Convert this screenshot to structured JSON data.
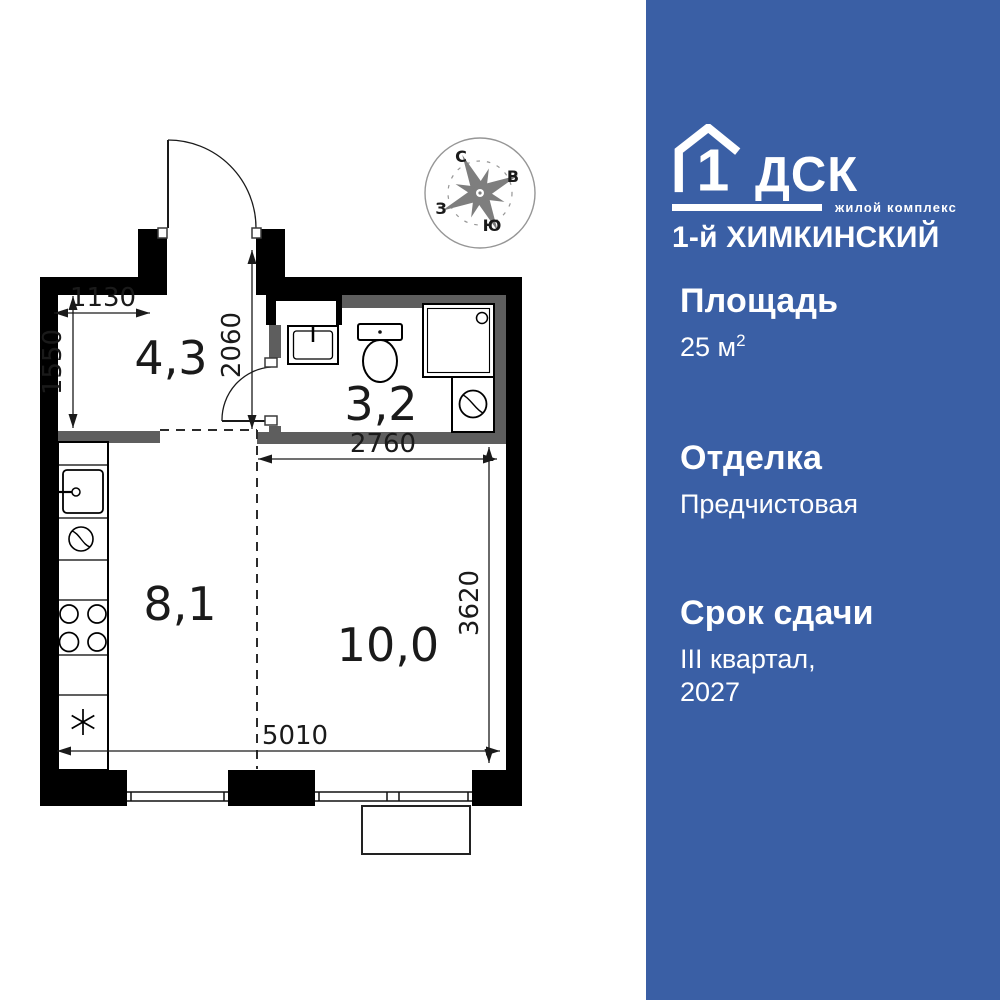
{
  "floorplan": {
    "room_areas": {
      "hallway": "4,3",
      "bathroom": "3,2",
      "kitchen": "8,1",
      "living_room": "10,0"
    },
    "dimensions_mm": {
      "hallway_width": "1130",
      "hallway_depth": "1550",
      "entry_depth": "2060",
      "room_width": "2760",
      "room_depth": "3620",
      "apartment_width": "5010"
    },
    "compass": {
      "north": "С",
      "east": "В",
      "south": "Ю",
      "west": "З"
    }
  },
  "panel": {
    "bg_color": "#3a5fa5",
    "logo": {
      "house_number": "1",
      "brand": "ДСК",
      "tagline": "жилой комплекс",
      "complex_name": "1-й ХИМКИНСКИЙ"
    },
    "sections": {
      "area": {
        "label": "Площадь",
        "value": "25 м",
        "value_sup": "2"
      },
      "finish": {
        "label": "Отделка",
        "value": "Предчистовая"
      },
      "completion": {
        "label": "Срок сдачи",
        "value_line1": "III квартал,",
        "value_line2": "2027"
      }
    }
  }
}
